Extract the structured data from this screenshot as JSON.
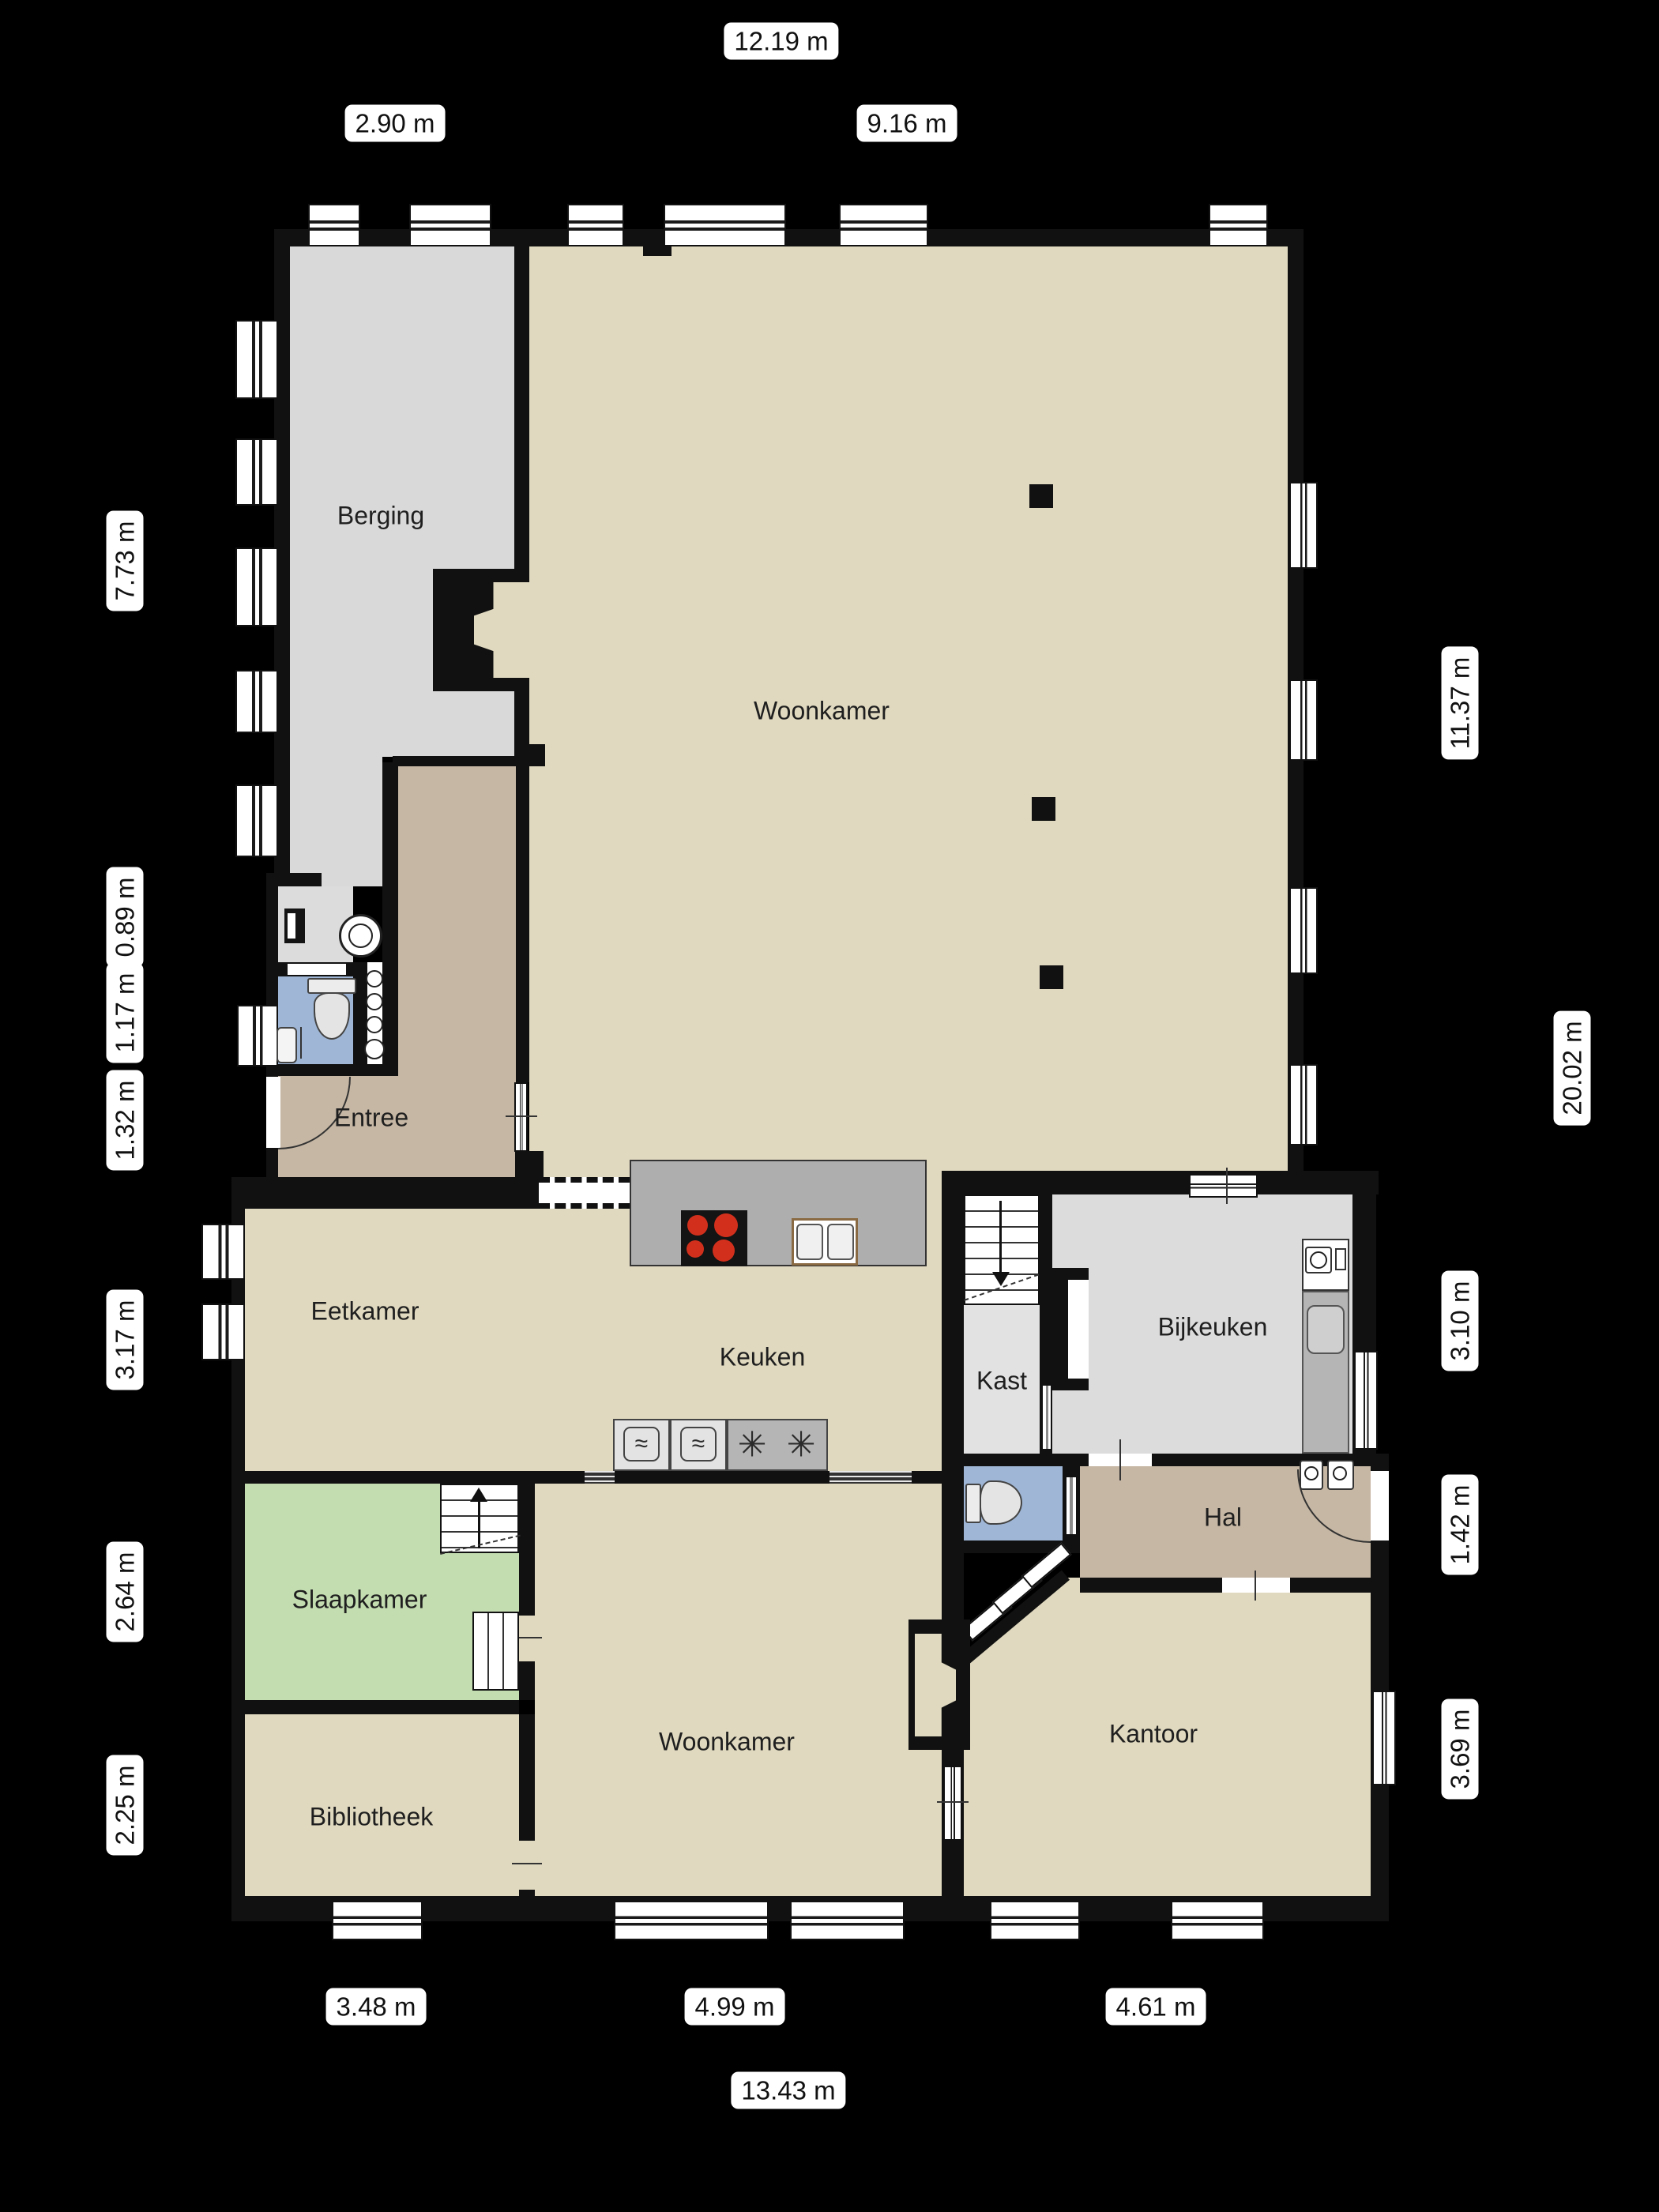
{
  "rooms": {
    "berging": "Berging",
    "woonkamer_boven": "Woonkamer",
    "entree": "Entree",
    "eetkamer": "Eetkamer",
    "keuken": "Keuken",
    "kast": "Kast",
    "bijkeuken": "Bijkeuken",
    "hal": "Hal",
    "slaapkamer": "Slaapkamer",
    "woonkamer_beneden": "Woonkamer",
    "bibliotheek": "Bibliotheek",
    "kantoor": "Kantoor"
  },
  "dims": {
    "top": [
      "12.19 m",
      "2.90 m",
      "9.16 m"
    ],
    "left": [
      "7.73 m",
      "0.89 m",
      "1.17 m",
      "1.32 m",
      "3.17 m",
      "2.64 m",
      "2.25 m"
    ],
    "right": [
      "11.37 m",
      "20.02 m",
      "3.10 m",
      "1.42 m",
      "3.69 m"
    ],
    "bottom": [
      "3.48 m",
      "4.99 m",
      "4.61 m",
      "13.43 m"
    ]
  },
  "icons": {
    "oven_wave": "≈",
    "freezer_star": "✳"
  },
  "colors": {
    "background": "#000000",
    "wall": "#111111",
    "room_beige": "#e0d9bf",
    "room_gray": "#d9d9d9",
    "room_gray2": "#dcdcdc",
    "room_green": "#c3dcb0",
    "room_blue": "#9fb6d6",
    "room_brown": "#c6b7a4",
    "counter_gray": "#aeaeae",
    "appliance_gray": "#b5b5b5",
    "burner_red": "#d2301c",
    "window_white": "#ffffff"
  }
}
